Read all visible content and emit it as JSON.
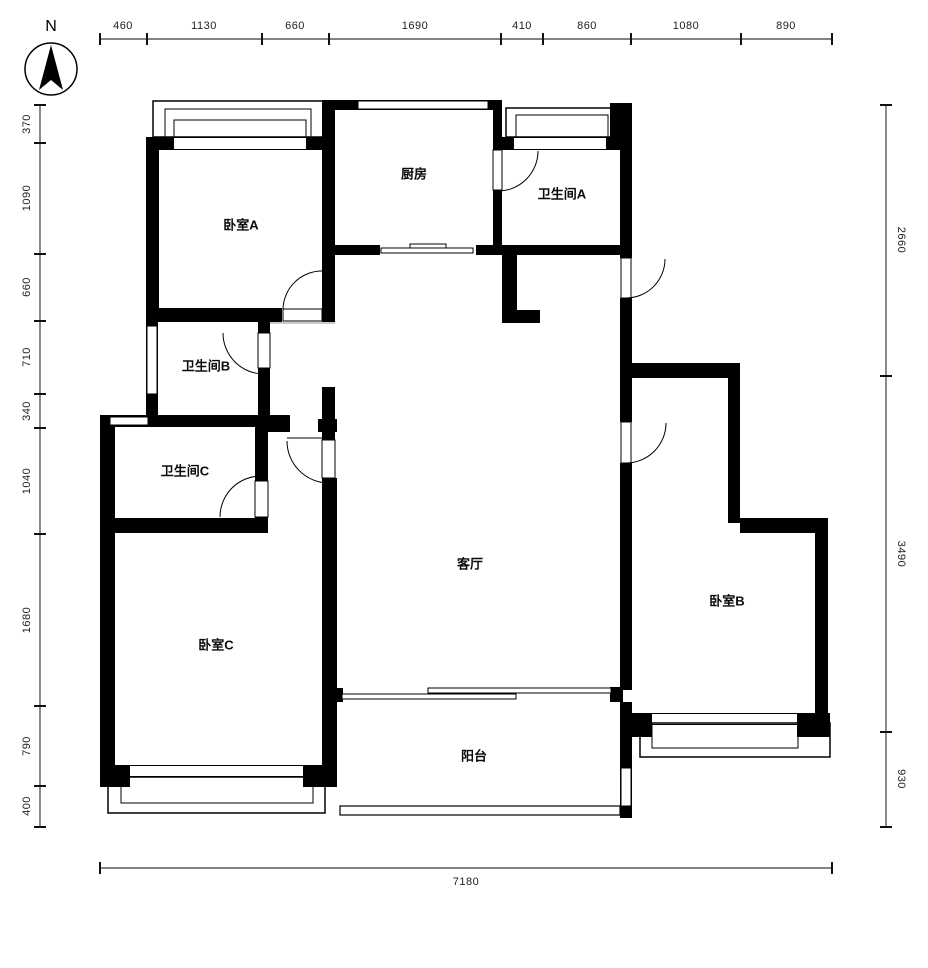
{
  "compass": {
    "label": "N"
  },
  "rooms": {
    "bedroom_a": "卧室A",
    "kitchen": "厨房",
    "bathroom_a": "卫生间A",
    "bathroom_b": "卫生间B",
    "bathroom_c": "卫生间C",
    "living_room": "客厅",
    "bedroom_b": "卧室B",
    "bedroom_c": "卧室C",
    "balcony": "阳台"
  },
  "dimensions": {
    "top": [
      "460",
      "1130",
      "660",
      "1690",
      "410",
      "860",
      "1080",
      "890"
    ],
    "left": [
      "370",
      "1090",
      "660",
      "710",
      "340",
      "1040",
      "1680",
      "790",
      "400"
    ],
    "right": [
      "2660",
      "3490",
      "930"
    ],
    "bottom": [
      "7180"
    ]
  },
  "colors": {
    "wall": "#000000",
    "dim_line": "#5a5a5a",
    "dim_text": "#222222"
  }
}
